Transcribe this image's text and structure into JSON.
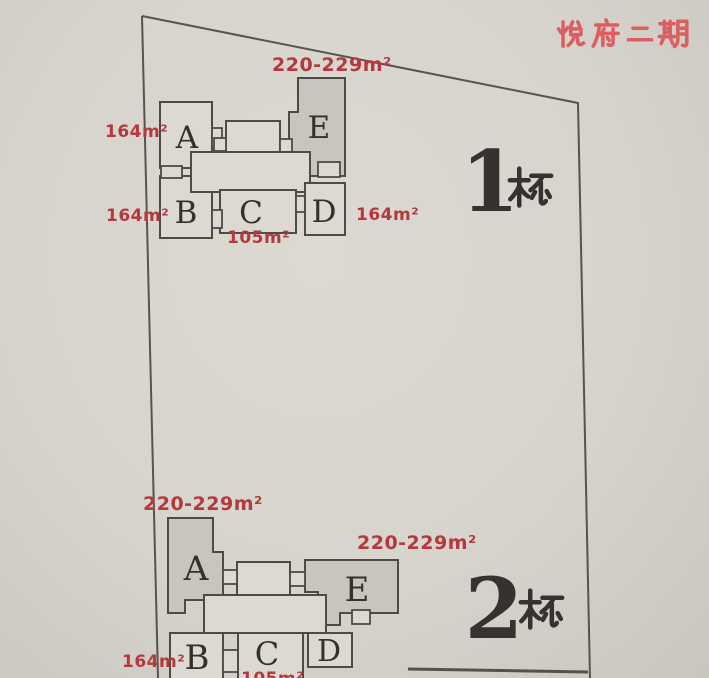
{
  "title": {
    "text": "悦府二期"
  },
  "buildings": [
    {
      "name": "1栋",
      "label_number": "1",
      "label_suffix": "栋",
      "units": [
        {
          "label": "A",
          "area": "164m²"
        },
        {
          "label": "B",
          "area": "164m²"
        },
        {
          "label": "C",
          "area": "105m²"
        },
        {
          "label": "D",
          "area": "164m²"
        },
        {
          "label": "E",
          "area": "220-229m²"
        }
      ]
    },
    {
      "name": "2栋",
      "label_number": "2",
      "label_suffix": "栋",
      "units": [
        {
          "label": "A",
          "area": "220-229m²"
        },
        {
          "label": "B",
          "area": "164m²"
        },
        {
          "label": "C",
          "area": "105m²"
        },
        {
          "label": "D"
        },
        {
          "label": "E",
          "area": "220-229m²"
        }
      ]
    }
  ],
  "colors": {
    "area_label_red": "#b5383c",
    "title_red": "#dd5e61",
    "ink": "#35332f",
    "shaded_unit_fill": "#c8c5bf",
    "paper": "#d7d3cd"
  }
}
